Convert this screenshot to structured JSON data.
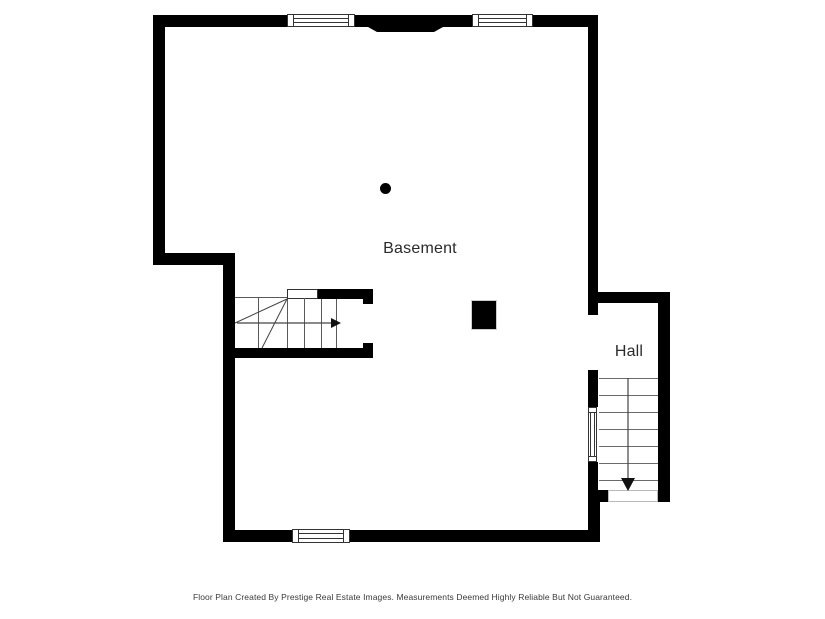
{
  "canvas": {
    "width": 825,
    "height": 619,
    "background": "#ffffff"
  },
  "rooms": {
    "basement": {
      "label": "Basement"
    },
    "hall": {
      "label": "Hall"
    }
  },
  "stairs": {
    "basement_staircase": {
      "direction_icon": "arrow-right",
      "treads": 5,
      "winders": 2
    },
    "hall_staircase": {
      "direction_icon": "arrow-down",
      "treads": 7
    }
  },
  "markers": {
    "support_post": "filled-circle",
    "structural_column": "filled-square"
  },
  "footer": {
    "disclaimer": "Floor Plan Created By Prestige Real Estate Images. Measurements Deemed Highly Reliable But Not Guaranteed."
  },
  "colors": {
    "wall": "#000000",
    "stair_line": "#5a5a5a",
    "window_outline": "#333333",
    "label_text": "#2b2b2b",
    "footer_text": "#3a3a3a"
  }
}
